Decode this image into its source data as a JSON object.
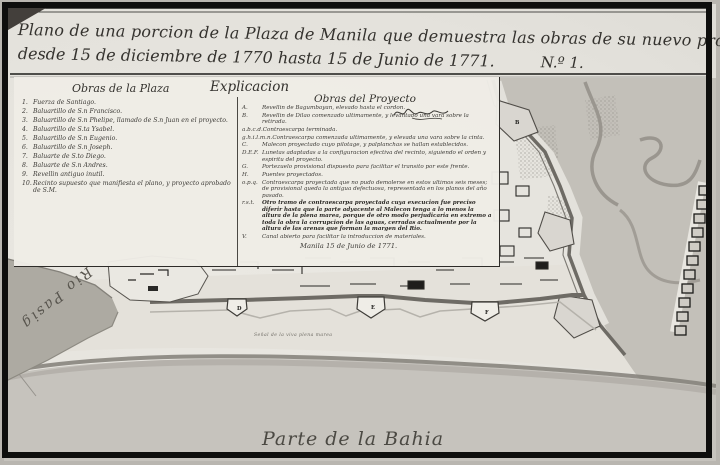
{
  "title": {
    "line1": "Plano de una porcion de la Plaza de Manila que demuestra las obras de su nuevo proyecto executadas",
    "line2": "desde 15 de diciembre de 1770 hasta 15 de Junio de 1771.",
    "number": "N.º 1."
  },
  "legend": {
    "explicacion_heading": "Explicacion",
    "plaza": {
      "heading": "Obras de la Plaza",
      "items": [
        {
          "key": "1.",
          "text": "Fuerza de Santiago."
        },
        {
          "key": "2.",
          "text": "Baluartillo de S.n Francisco."
        },
        {
          "key": "3.",
          "text": "Baluartillo de S.n Phelipe, llamado de S.n Juan en el proyecto."
        },
        {
          "key": "4.",
          "text": "Baluartillo de S.ta Ysabel."
        },
        {
          "key": "5.",
          "text": "Baluartillo de S.n Eugenio."
        },
        {
          "key": "6.",
          "text": "Baluartillo de S.n Joseph."
        },
        {
          "key": "7.",
          "text": "Baluarte de S.to Diego."
        },
        {
          "key": "8.",
          "text": "Baluarte de S.n Andres."
        },
        {
          "key": "9.",
          "text": "Revellin antiguo inutil."
        },
        {
          "key": "10.",
          "text": "Recinto supuesto que manifiesta el plano, y proyecto aprobado de S.M."
        }
      ]
    },
    "proyecto": {
      "heading": "Obras del Proyecto",
      "items": [
        {
          "key": "A.",
          "text": "Revellin de Bagumbayan, elevado hasta el cordon."
        },
        {
          "key": "B.",
          "text": "Revellin de Dilao comenzado ultimamente, y levantado una vara sobre la retirada."
        },
        {
          "key": "a.b.c.d.",
          "text": "Contraescarpa terminada."
        },
        {
          "key": "g.h.i.l.m.n.",
          "text": "Contraescarpa comenzada ultimamente, y elevada una vara sobre la cinta."
        },
        {
          "key": "C.",
          "text": "Malecon proyectado cuyo pilotage, y palplanchas se hallan establecidos."
        },
        {
          "key": "D.E.F.",
          "text": "Lunetas adaptadas a la configuracion efectiva del recinto, siguiendo el orden y espiritu del proyecto."
        },
        {
          "key": "G.",
          "text": "Portezuelo provisional dispuesto para facilitar el transito por este frente."
        },
        {
          "key": "H.",
          "text": "Puentes proyectados."
        },
        {
          "key": "o.p.q.",
          "text": "Contraescarpa proyectada que no pudo demolerse en estos ultimos seis meses; de provisional queda la antigua defectuosa, representada en los planos del año pasado."
        },
        {
          "key": "r.s.t.",
          "text": "Otro tramo de contraescarpa proyectada cuya execucion fue preciso diferir hasta que la parte adyacente al Malecon tenga a lo menos la altura de la plena marea, porque de otro modo perjudicaria en extremo a toda la obra la corrupcion de las aguas, cerradas actualmente por la altura de las arenas que forman la margen del Rio."
        },
        {
          "key": "V.",
          "text": "Canal abierto para facilitar la introduccion de materiales."
        }
      ],
      "dateline": "Manila 15 de Junio de 1771."
    }
  },
  "map": {
    "river_label": "Rio Pasig",
    "bay_label": "Parte de la Bahia",
    "tide_label": "Señal de la viva plena marea",
    "markers": {
      "b": "B",
      "d": "D",
      "e": "E",
      "f": "F"
    }
  }
}
